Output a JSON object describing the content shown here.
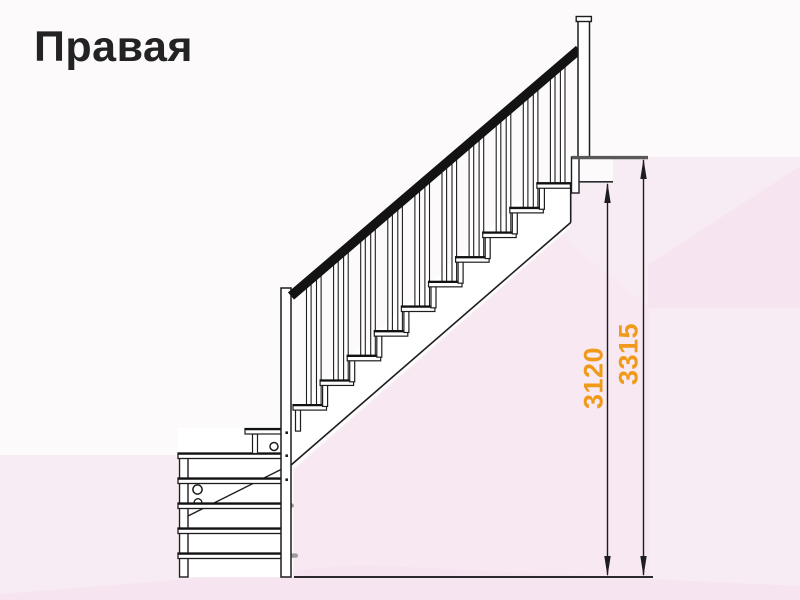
{
  "page": {
    "title": "Правая"
  },
  "diagram": {
    "dimensions": [
      {
        "name": "height-to-landing",
        "value": "3120"
      },
      {
        "name": "total-height",
        "value": "3315"
      }
    ],
    "colors": {
      "dimension_label": "#F09A1A",
      "line": "#1d1d1f",
      "handrail": "#131313",
      "background_tint": "#f8ecf4"
    }
  }
}
